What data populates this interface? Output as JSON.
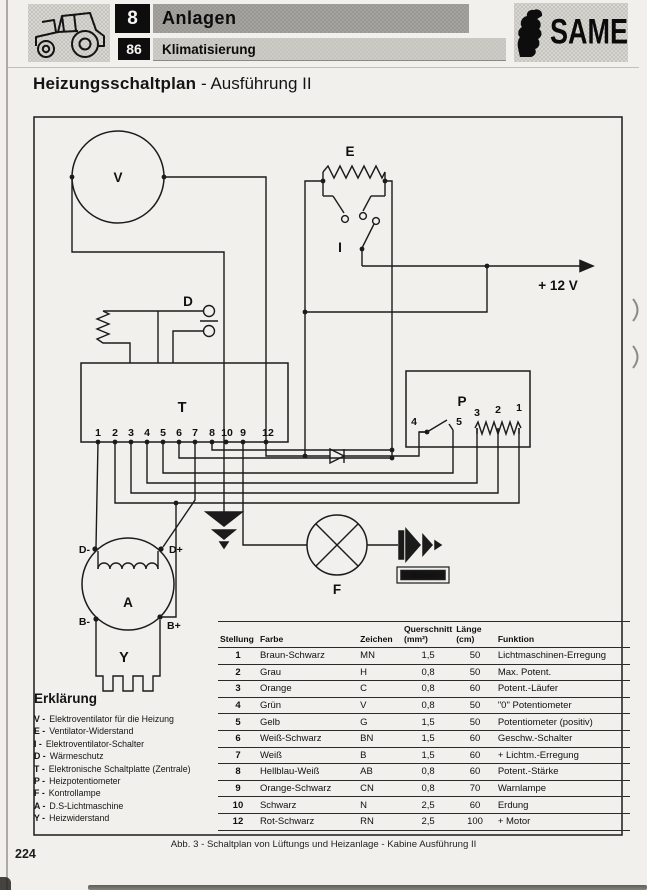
{
  "header": {
    "section_code": "8",
    "section_title": "Anlagen",
    "subsection_code": "86",
    "subsection_title": "Klimatisierung",
    "brand": "SAME"
  },
  "title": {
    "main": "Heizungsschaltplan",
    "sep": "-",
    "suffix": "Ausführung II"
  },
  "diagram": {
    "labels": {
      "v": "V",
      "e": "E",
      "i": "I",
      "d": "D",
      "t": "T",
      "p": "P",
      "a": "A",
      "y": "Y",
      "f": "F",
      "supply": "+ 12 V",
      "d_minus": "D-",
      "d_plus": "D+",
      "b_minus": "B-",
      "b_plus": "B+",
      "part_tag": "86T0963"
    },
    "t_terminals": [
      "1",
      "2",
      "3",
      "4",
      "5",
      "6",
      "7",
      "8",
      "10",
      "9",
      "12"
    ],
    "p_switch_terminals": [
      "4",
      "5"
    ],
    "p_pot_terminals": [
      "3",
      "2",
      "1"
    ]
  },
  "legend": {
    "title": "Erklärung",
    "items": [
      {
        "key": "V -",
        "desc": "Elektroventilator für die Heizung"
      },
      {
        "key": "E -",
        "desc": "Ventilator-Widerstand"
      },
      {
        "key": "I -",
        "desc": "Elektroventilator-Schalter"
      },
      {
        "key": "D -",
        "desc": "Wärmeschutz"
      },
      {
        "key": "T -",
        "desc": "Elektronische Schaltplatte (Zentrale)"
      },
      {
        "key": "P -",
        "desc": "Heizpotentiometer"
      },
      {
        "key": "F -",
        "desc": "Kontrollampe"
      },
      {
        "key": "A -",
        "desc": "D.S-Lichtmaschine"
      },
      {
        "key": "Y -",
        "desc": "Heizwiderstand"
      }
    ]
  },
  "wire_table": {
    "headers": {
      "stellung": "Stellung",
      "farbe": "Farbe",
      "zeichen": "Zeichen",
      "querschnitt_l1": "Querschnitt",
      "querschnitt_l2": "(mm²)",
      "laenge_l1": "Länge",
      "laenge_l2": "(cm)",
      "funktion": "Funktion"
    },
    "rows": [
      {
        "stellung": "1",
        "farbe": "Braun-Schwarz",
        "zeichen": "MN",
        "querschnitt": "1,5",
        "laenge": "50",
        "funktion": "Lichtmaschinen-Erregung"
      },
      {
        "stellung": "2",
        "farbe": "Grau",
        "zeichen": "H",
        "querschnitt": "0,8",
        "laenge": "50",
        "funktion": "Max. Potent."
      },
      {
        "stellung": "3",
        "farbe": "Orange",
        "zeichen": "C",
        "querschnitt": "0,8",
        "laenge": "60",
        "funktion": "Potent.-Läufer"
      },
      {
        "stellung": "4",
        "farbe": "Grün",
        "zeichen": "V",
        "querschnitt": "0,8",
        "laenge": "50",
        "funktion": "\"0\" Potentiometer"
      },
      {
        "stellung": "5",
        "farbe": "Gelb",
        "zeichen": "G",
        "querschnitt": "1,5",
        "laenge": "50",
        "funktion": "Potentiometer (positiv)"
      },
      {
        "stellung": "6",
        "farbe": "Weiß-Schwarz",
        "zeichen": "BN",
        "querschnitt": "1,5",
        "laenge": "60",
        "funktion": "Geschw.-Schalter"
      },
      {
        "stellung": "7",
        "farbe": "Weiß",
        "zeichen": "B",
        "querschnitt": "1,5",
        "laenge": "60",
        "funktion": "+ Lichtm.-Erregung"
      },
      {
        "stellung": "8",
        "farbe": "Hellblau-Weiß",
        "zeichen": "AB",
        "querschnitt": "0,8",
        "laenge": "60",
        "funktion": "Potent.-Stärke"
      },
      {
        "stellung": "9",
        "farbe": "Orange-Schwarz",
        "zeichen": "CN",
        "querschnitt": "0,8",
        "laenge": "70",
        "funktion": "Warnlampe"
      },
      {
        "stellung": "10",
        "farbe": "Schwarz",
        "zeichen": "N",
        "querschnitt": "2,5",
        "laenge": "60",
        "funktion": "Erdung"
      },
      {
        "stellung": "12",
        "farbe": "Rot-Schwarz",
        "zeichen": "RN",
        "querschnitt": "2,5",
        "laenge": "100",
        "funktion": "+ Motor"
      }
    ]
  },
  "caption": "Abb. 3 - Schaltplan von Lüftungs und Heizanlage - Kabine Ausführung II",
  "page_number": "224"
}
